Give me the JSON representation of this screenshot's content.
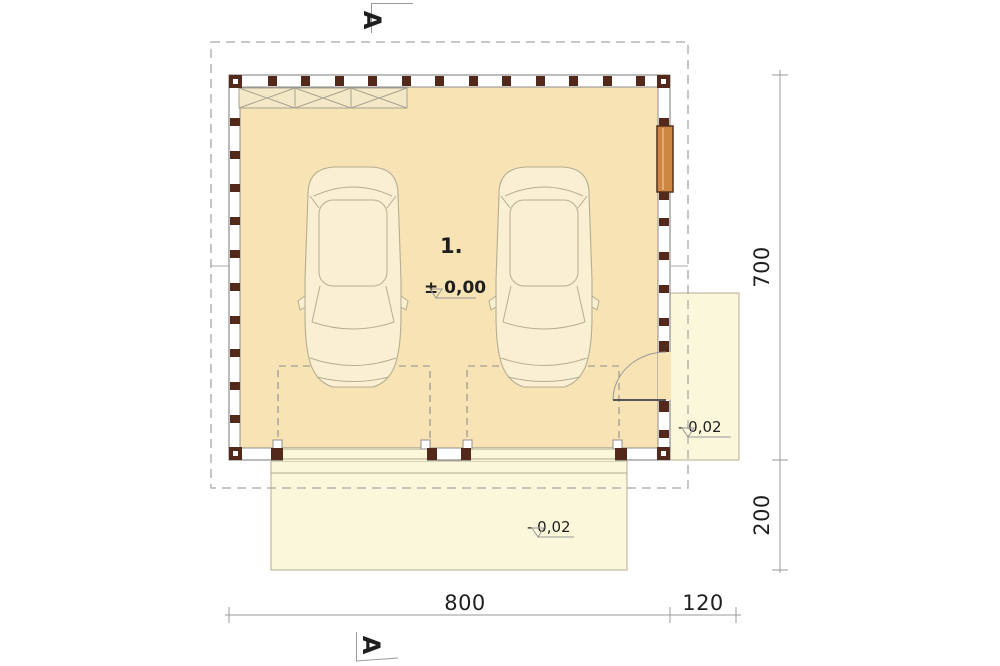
{
  "plan": {
    "room_label": "1.",
    "floor_level_label": "± 0,00",
    "side_pad_level_label": "- 0,02",
    "driveway_level_label": "- 0,02",
    "section_top_label": "A",
    "section_bottom_label": "A"
  },
  "dimensions": {
    "height_main": "700",
    "height_driveway": "200",
    "width_main": "800",
    "width_side_pad": "120"
  },
  "colors": {
    "interior_floor": "#f7e3b3",
    "paving": "#fbf7da",
    "bench_fill": "#f3e9c7",
    "timber_post": "#52291a",
    "window_orange": "#cd8743",
    "car_fill": "#f9efd2",
    "car_line": "#b6ae93",
    "wall_line": "#8f8f8f",
    "dashed_line": "#a8a8a8",
    "dim_line": "#9a9a9a",
    "text": "#1f1f1f"
  }
}
